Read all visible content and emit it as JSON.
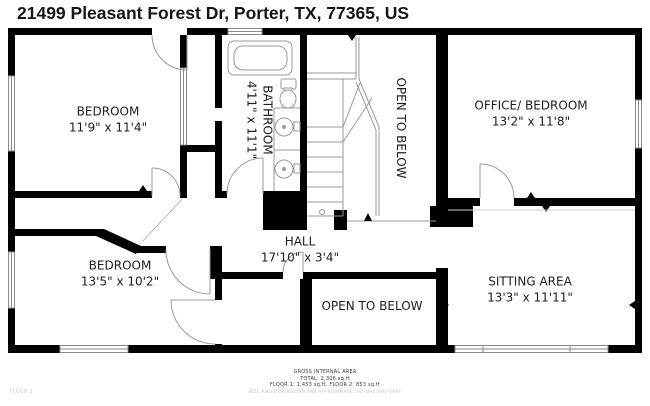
{
  "header": {
    "address": "21499 Pleasant Forest Dr, Porter, TX, 77365, US"
  },
  "rooms": [
    {
      "id": "bedroom-top-left",
      "name": "BEDROOM",
      "dims": "11'9\" x 11'4\""
    },
    {
      "id": "bathroom",
      "name": "BATHROOM",
      "dims": "4'11\" x 11'1\""
    },
    {
      "id": "open-to-below-top",
      "name": "OPEN TO BELOW"
    },
    {
      "id": "office-bedroom",
      "name": "OFFICE/ BEDROOM",
      "dims": "13'2\" x 11'8\""
    },
    {
      "id": "bedroom-bottom-left",
      "name": "BEDROOM",
      "dims": "13'5\" x 10'2\""
    },
    {
      "id": "hall",
      "name": "HALL",
      "dims": "17'10\" x 3'4\""
    },
    {
      "id": "open-to-below-bottom",
      "name": "OPEN TO BELOW"
    },
    {
      "id": "sitting-area",
      "name": "SITTING AREA",
      "dims": "13'3\" x 11'11\""
    }
  ],
  "footer": {
    "area_title": "GROSS INTERNAL AREA",
    "total": "TOTAL: 2,306 sq.ft",
    "floors": "FLOOR 1: 1,453 sq.ft, FLOOR 2: 853 sq.ft",
    "disclaimer": "SIZE AND DIMENSIONS ARE APPROXIMATE, ACTUAL MAY VARY",
    "floor_label": "FLOOR 2"
  },
  "colors": {
    "wall": "#000000",
    "line": "#999999",
    "text": "#1d1d1d",
    "muted": "#c4c4c4"
  }
}
